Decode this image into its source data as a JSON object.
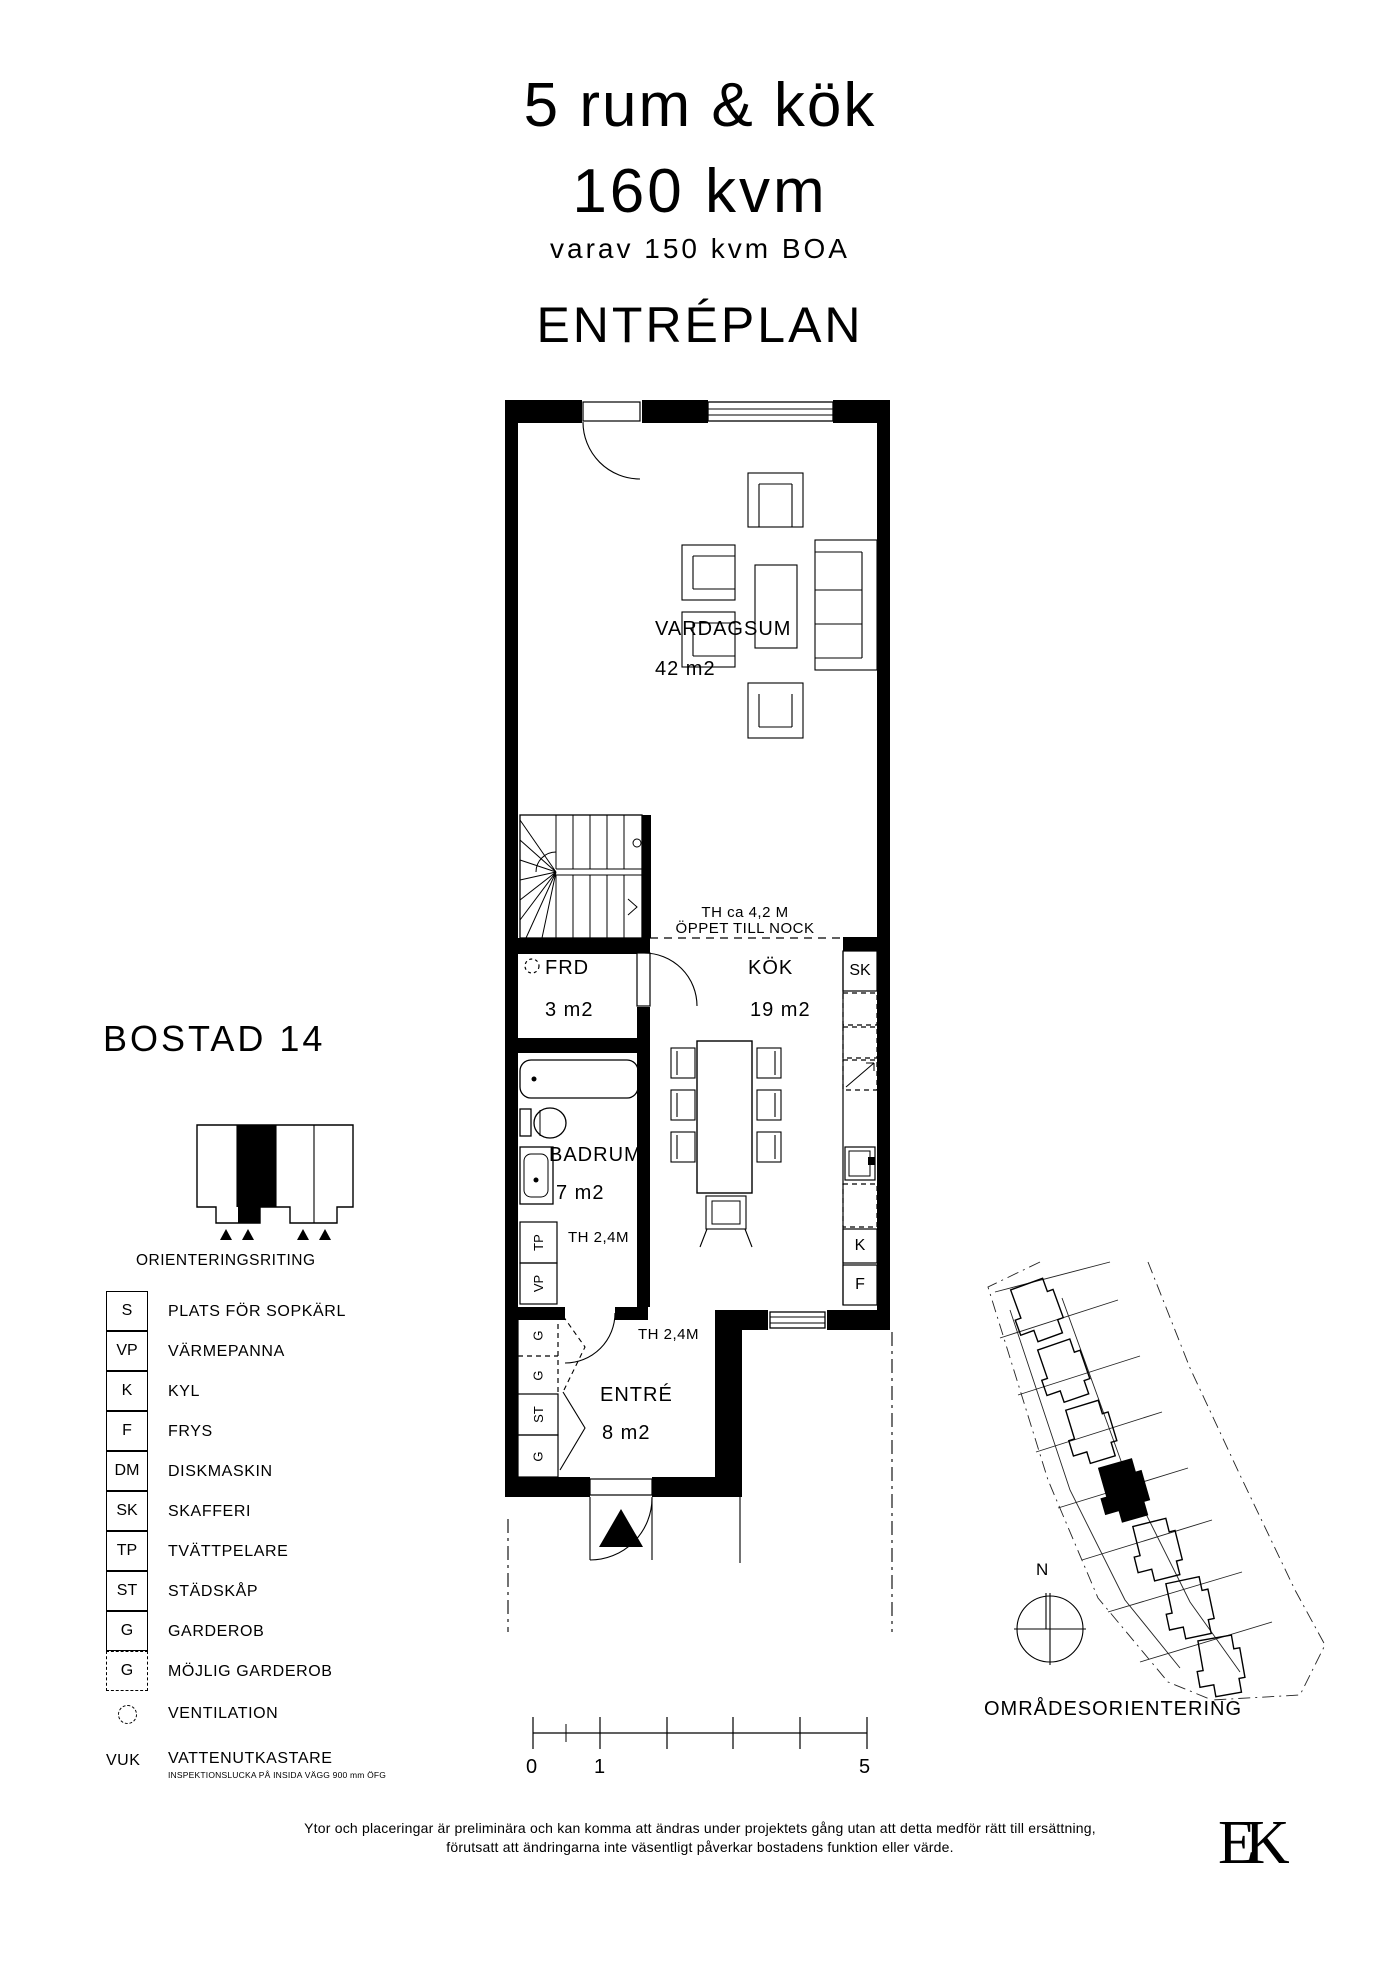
{
  "title": {
    "rooms": "5 rum & kök",
    "area": "160 kvm",
    "boa": "varav 150 kvm BOA",
    "floor": "ENTRÉPLAN"
  },
  "unit": {
    "name": "BOSTAD 14",
    "orientation_caption": "ORIENTERINGSRITING"
  },
  "legend": {
    "items": [
      {
        "code": "S",
        "label": "PLATS FÖR SOPKÄRL"
      },
      {
        "code": "VP",
        "label": "VÄRMEPANNA"
      },
      {
        "code": "K",
        "label": "KYL"
      },
      {
        "code": "F",
        "label": "FRYS"
      },
      {
        "code": "DM",
        "label": "DISKMASKIN"
      },
      {
        "code": "SK",
        "label": "SKAFFERI"
      },
      {
        "code": "TP",
        "label": "TVÄTTPELARE"
      },
      {
        "code": "ST",
        "label": "STÄDSKÅP"
      },
      {
        "code": "G",
        "label": "GARDEROB"
      },
      {
        "code": "G",
        "label": "MÖJLIG GARDEROB"
      },
      {
        "code": "",
        "label": "VENTILATION"
      },
      {
        "code": "VUK",
        "label": "VATTENUTKASTARE"
      }
    ],
    "vuk_note": "INSPEKTIONSLUCKA PÅ INSIDA VÄGG 900 mm ÖFG"
  },
  "plan": {
    "vardagsrum": {
      "name": "VARDAGSUM",
      "area": "42 m2"
    },
    "frd": {
      "name": "FRD",
      "area": "3 m2"
    },
    "kok": {
      "name": "KÖK",
      "area": "19 m2"
    },
    "badrum": {
      "name": "BADRUM",
      "area": "7 m2"
    },
    "entre": {
      "name": "ENTRÉ",
      "area": "8 m2"
    },
    "notes": {
      "ridge1": "TH ca 4,2 M",
      "ridge2": "ÖPPET TILL NOCK",
      "th_badrum": "TH 2,4M",
      "th_entre": "TH 2,4M"
    },
    "tags": {
      "sk": "SK",
      "k": "K",
      "f": "F",
      "tp": "TP",
      "vp": "VP",
      "g_top": "G",
      "g_mid": "G",
      "st": "ST",
      "g_bot": "G"
    }
  },
  "scalebar": {
    "t0": "0",
    "t1": "1",
    "t5": "5"
  },
  "siteplan": {
    "north": "N",
    "caption": "OMRÅDESORIENTERING"
  },
  "footer": {
    "line1": "Ytor och placeringar är preliminära och kan komma att ändras under projektets gång utan att detta medför rätt till ersättning,",
    "line2": "förutsatt att ändringarna inte väsentligt påverkar bostadens funktion eller värde."
  },
  "logo": {
    "text": "EK"
  },
  "colors": {
    "ink": "#000000",
    "paper": "#ffffff"
  }
}
